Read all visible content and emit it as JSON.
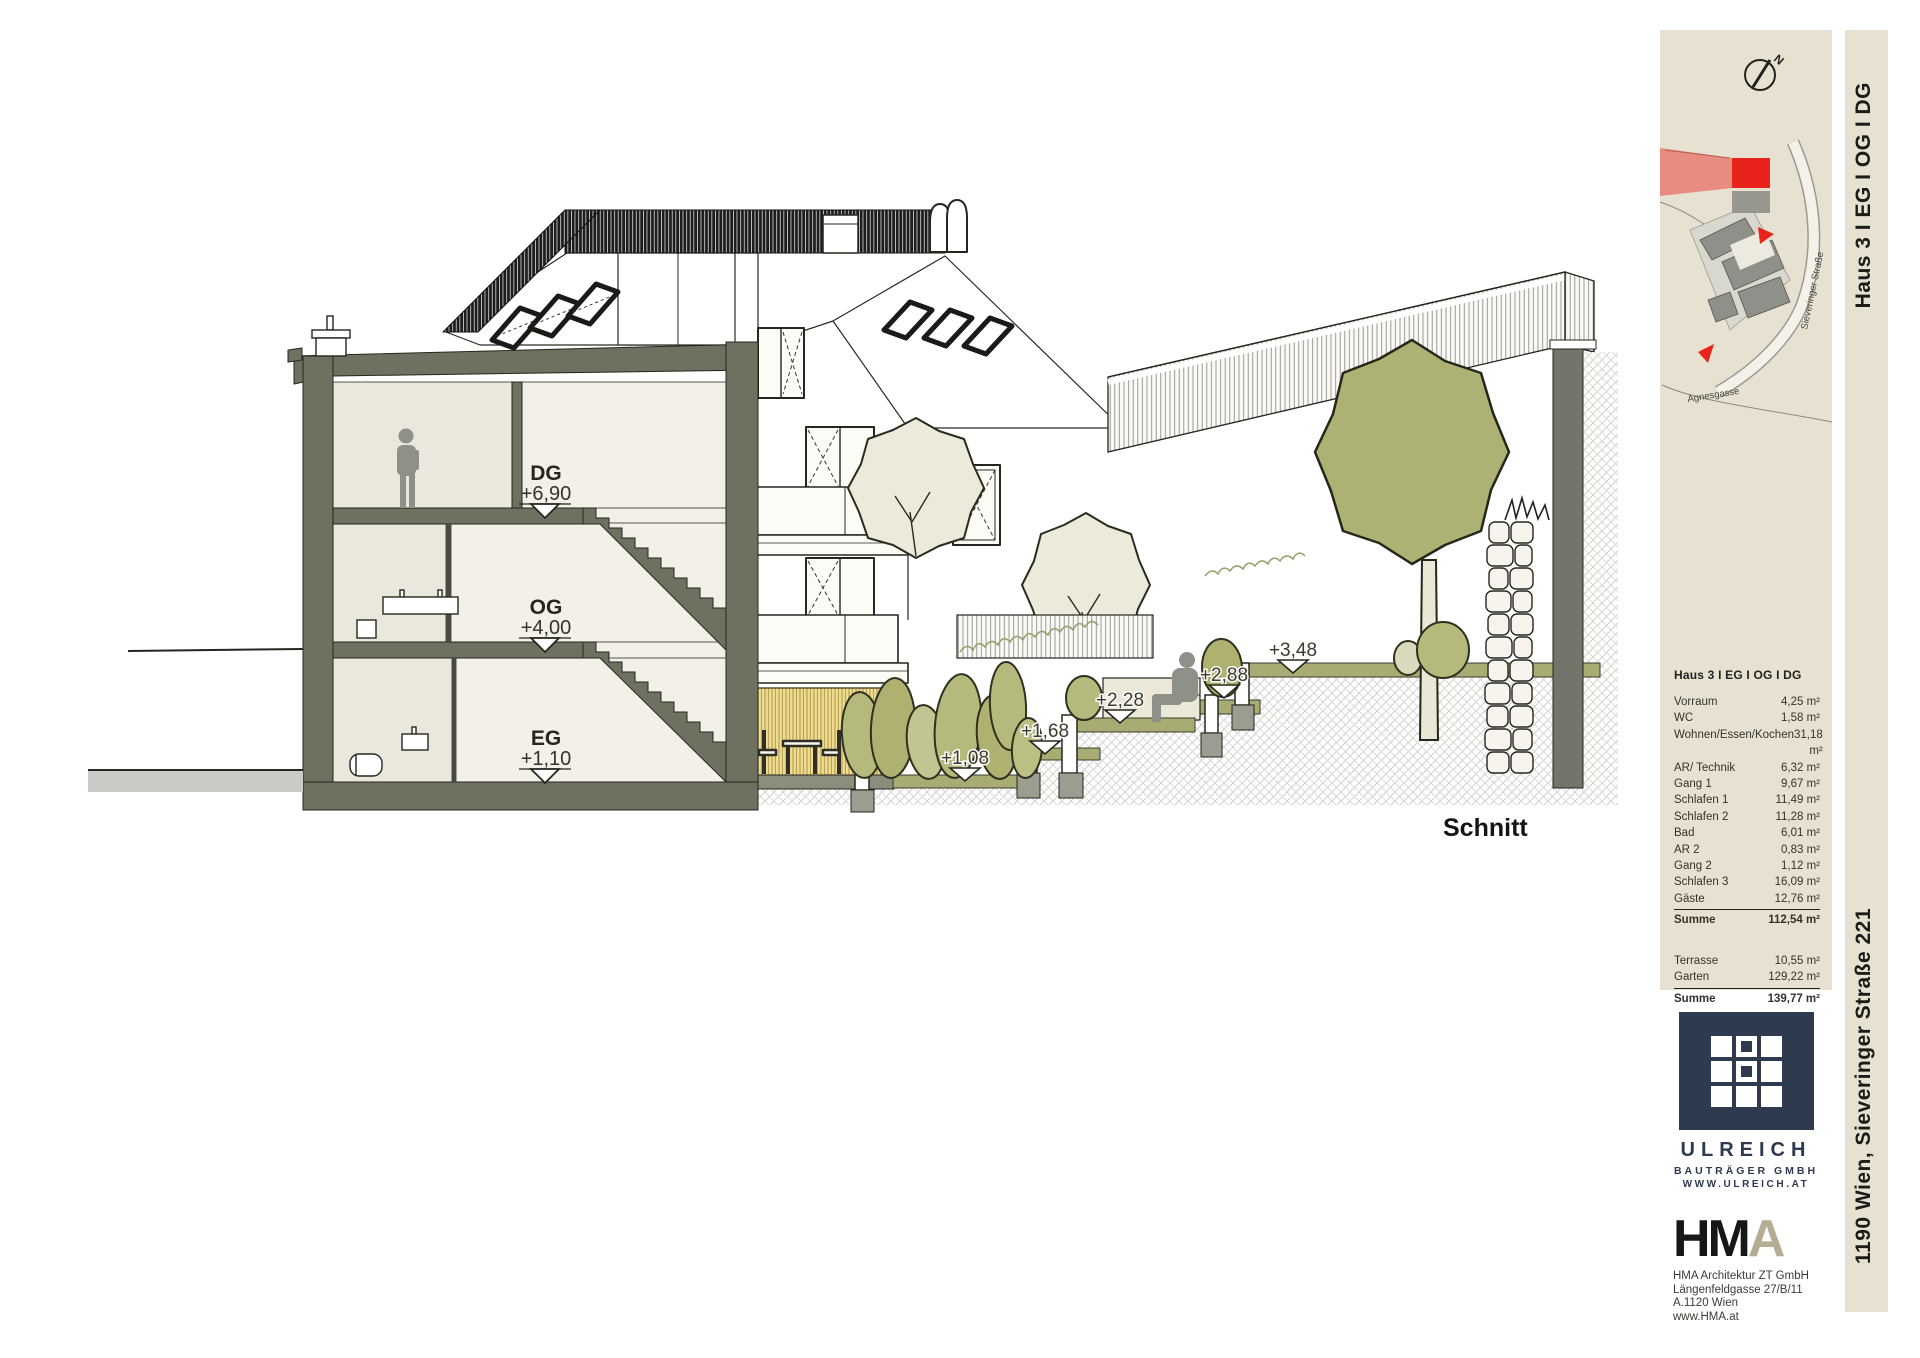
{
  "drawing": {
    "label": "Schnitt",
    "levels": [
      {
        "name": "DG",
        "elevation": "+6,90"
      },
      {
        "name": "OG",
        "elevation": "+4,00"
      },
      {
        "name": "EG",
        "elevation": "+1,10"
      }
    ],
    "terrain_markers": [
      "+3,48",
      "+2,88",
      "+2,28",
      "+1,68",
      "+1,08"
    ]
  },
  "site_plan": {
    "north_label": "N",
    "street_1": "Sieveringer Straße",
    "street_2": "Agnesgasse",
    "highlight_color": "#e8231c"
  },
  "area_table": {
    "header": "Haus 3 I EG I OG I DG",
    "rows": [
      {
        "label": "Vorraum",
        "value": "4,25 m²"
      },
      {
        "label": "WC",
        "value": "1,58 m²"
      },
      {
        "label": "Wohnen/Essen/Kochen",
        "value": "31,18 m²"
      },
      {
        "label": "AR/ Technik",
        "value": "6,32 m²"
      },
      {
        "label": "Gang 1",
        "value": "9,67 m²"
      },
      {
        "label": "Schlafen 1",
        "value": "11,49 m²"
      },
      {
        "label": "Schlafen 2",
        "value": "11,28 m²"
      },
      {
        "label": "Bad",
        "value": "6,01 m²"
      },
      {
        "label": "AR 2",
        "value": "0,83 m²"
      },
      {
        "label": "Gang 2",
        "value": "1,12 m²"
      },
      {
        "label": "Schlafen 3",
        "value": "16,09 m²"
      },
      {
        "label": "Gäste",
        "value": "12,76 m²"
      }
    ],
    "sum1": {
      "label": "Summe",
      "value": "112,54 m²"
    },
    "outdoor_rows": [
      {
        "label": "Terrasse",
        "value": "10,55 m²"
      },
      {
        "label": "Garten",
        "value": "129,22 m²"
      }
    ],
    "sum2": {
      "label": "Summe",
      "value": "139,77 m²"
    }
  },
  "ulreich": {
    "name": "ULREICH",
    "line2": "BAUTRÄGER GMBH",
    "line3": "WWW.ULREICH.AT"
  },
  "hma": {
    "logo_hm": "HM",
    "logo_a": "A",
    "line1": "HMA Architektur ZT GmbH",
    "line2": "Längenfeldgasse 27/B/11",
    "line3": "A.1120 Wien",
    "line4": "www.HMA.at"
  },
  "title_block": {
    "side_top": "Haus 3  I  EG I OG I DG",
    "side_bottom": "1190 Wien, Sieveringer Straße 221"
  }
}
